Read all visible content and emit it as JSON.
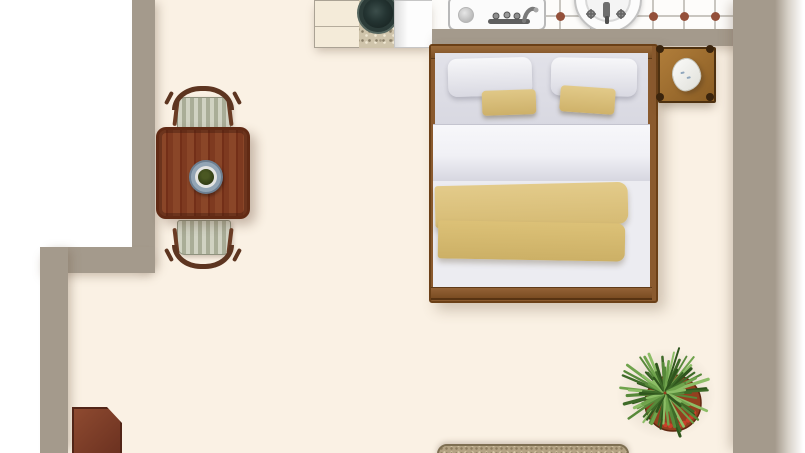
{
  "scene": {
    "description": "top-down rendered floor plan of a studio apartment",
    "rooms": [
      {
        "name": "main-room",
        "floor": "cream"
      },
      {
        "name": "bathroom-strip",
        "floor": "white-tile-with-brown-dots"
      },
      {
        "name": "kitchenette",
        "floor": "cream"
      }
    ],
    "items": [
      {
        "name": "double-bed",
        "details": "wood frame, two white pillows, two khaki accent pillows, white duvet, khaki folded throw"
      },
      {
        "name": "nightstand",
        "details": "wood, corner knobs, white telephone on top"
      },
      {
        "name": "dining-table",
        "details": "square dark wood table with decorative plate"
      },
      {
        "name": "dining-chair-north",
        "details": "striped upholstered seat, curved wood back"
      },
      {
        "name": "dining-chair-south",
        "details": "striped upholstered seat, curved wood back"
      },
      {
        "name": "kitchen-cabinet",
        "details": "cream counter block"
      },
      {
        "name": "granite-counter-with-basin",
        "details": "speckled counter, dark round basin"
      },
      {
        "name": "kitchen-appliance",
        "details": "white appliance top"
      },
      {
        "name": "kitchen-sink",
        "details": "rectangular white sink, chrome faucet, drain left"
      },
      {
        "name": "pedestal-sink",
        "details": "round white sink with faucet, partially cut by top edge"
      },
      {
        "name": "potted-plant",
        "details": "spiky green plant in terracotta pot with red berries"
      },
      {
        "name": "door-leaf",
        "details": "red-brown door panel, bevelled corner, bottom-left"
      },
      {
        "name": "rug",
        "details": "speckled beige runner at bottom edge"
      }
    ]
  },
  "palette": {
    "outside": "#ffffff",
    "wall": "#a49a8c",
    "floor": "#faf1e4",
    "tile_white": "#fdfcfa",
    "grout": "#c9c6c0",
    "tile_dot": "#94503a",
    "wood_bed": "#8a5a2e",
    "table_wood": "#7e3a20",
    "table_border": "#612a14",
    "chair_wood": "#5d3520",
    "khaki": "#dcc480",
    "linen_white": "#ececf1",
    "nightstand_wood": "#a0702f",
    "cabinet": "#f4ebd9",
    "granite": "#cfc4ab",
    "basin_dark": "#22302f",
    "plate_rim": "#93a5b5",
    "plate_food": "#36421a",
    "door_wood": "#8e4a30",
    "rug_base": "#b3a283",
    "rug_border": "#7e6f52",
    "plant_pot": "#93401f",
    "plant_berry": "#c8402a"
  },
  "tiles": {
    "offsets": [
      15,
      46,
      77,
      108,
      139,
      170
    ],
    "line_y": 15,
    "dot_r": 4.5
  },
  "plant": {
    "leaf_count": 56,
    "greens": [
      "#3e6a28",
      "#57893a",
      "#6fa34c",
      "#8cbd66",
      "#2f551d"
    ],
    "center": {
      "x": 55,
      "y": 56
    },
    "pot": {
      "cx": 63,
      "cy": 66,
      "r": 28
    },
    "berry_count": 9
  }
}
